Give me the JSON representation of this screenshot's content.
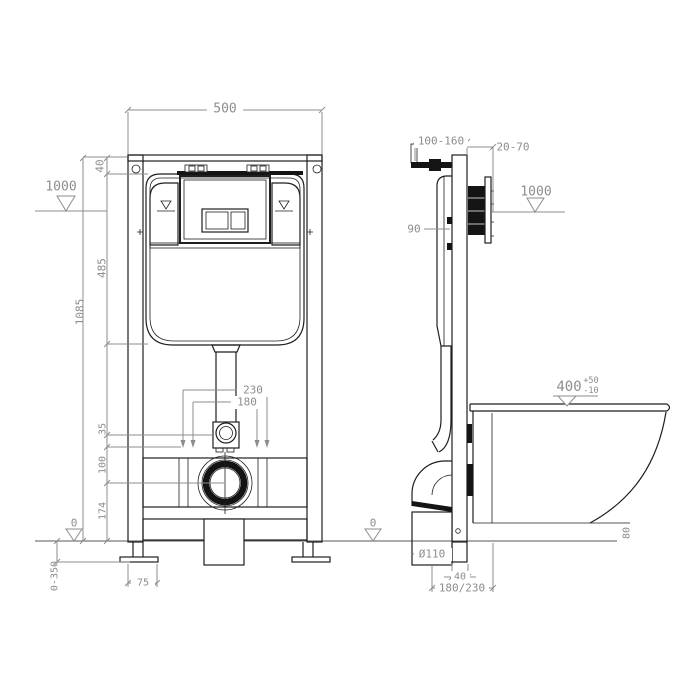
{
  "drawing_title": "wall-hung toilet concealed cistern frame installation drawing",
  "colors": {
    "line": "#1f1f1f",
    "dimension": "#8d8d8d",
    "background": "#ffffff"
  },
  "front_view": {
    "frame_width": "500",
    "top_offset": "40",
    "cistern_height": "485",
    "frame_height": "1085",
    "level_top": "1000",
    "bolt_span_outer": "230",
    "bolt_span_inner": "180",
    "inlet_gap": "35",
    "inlet_to_drain": "100",
    "drain_height": "174",
    "level_floor": "0",
    "foot_adjust_range": "0-350",
    "foot_plate_width": "75"
  },
  "side_view": {
    "frame_depth_range": "100-160",
    "wall_thickness_range": "20-70",
    "level_top": "1000",
    "plate_offset": "90",
    "bowl_depth": "400",
    "bowl_depth_tol_plus": "+50",
    "bowl_depth_tol_minus": "-10",
    "bowl_floor_clearance": "80",
    "level_floor": "0",
    "drain_pipe_diameter": "Ø110",
    "below_floor_depth": "40",
    "drain_center_distance": "180/230"
  }
}
